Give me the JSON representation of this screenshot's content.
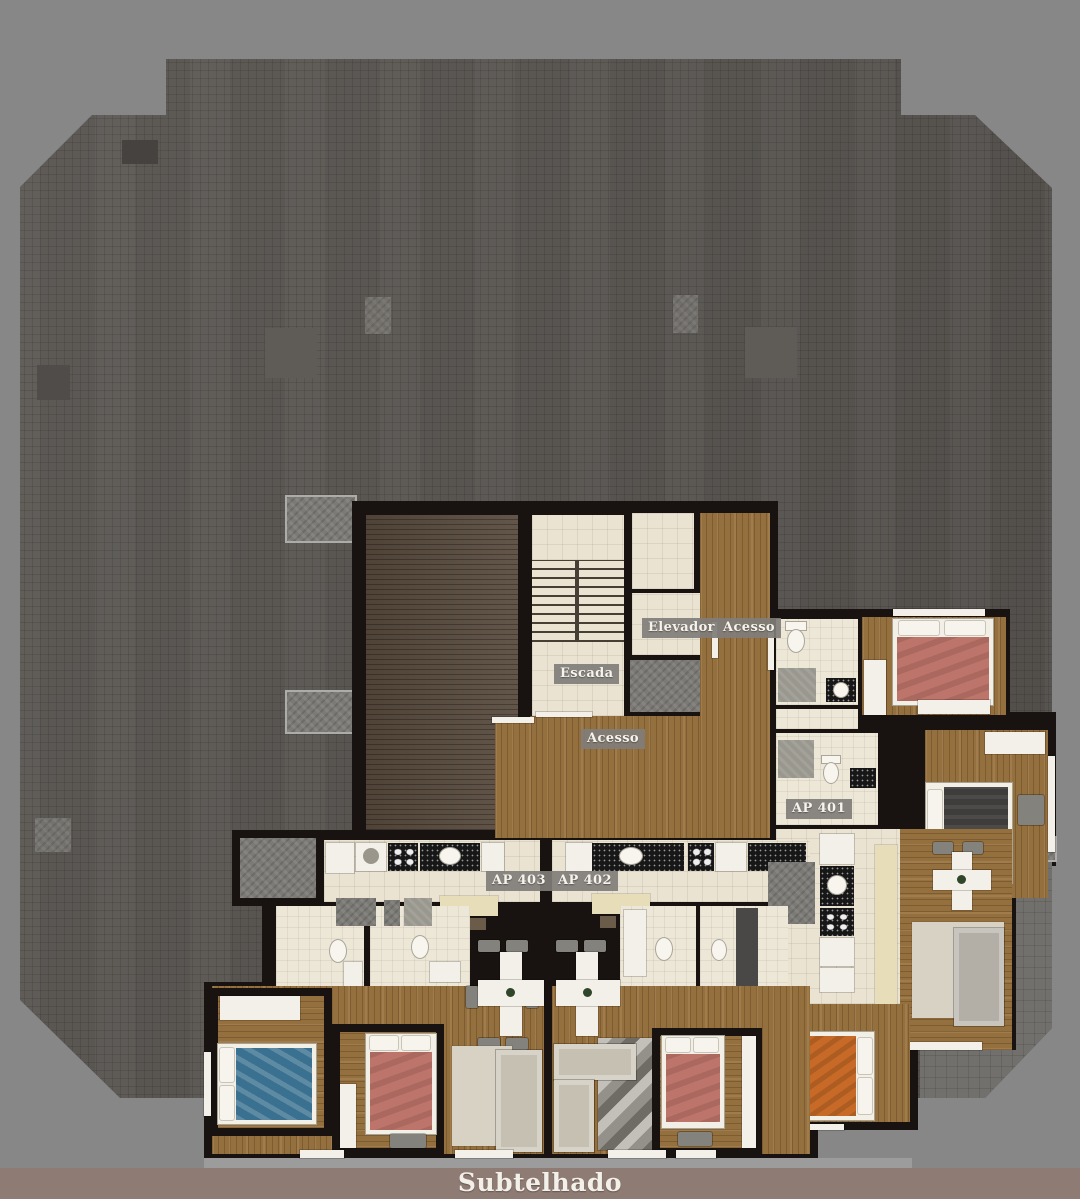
{
  "scene": {
    "type": "apartment-floor-plan-render",
    "floor_name": "Subtelhado"
  },
  "footer": {
    "title": "Subtelhado"
  },
  "plan_labels": {
    "elevator": "Elevador",
    "stairs": "Escada",
    "access_upper": "Acesso",
    "access_lower": "Acesso",
    "apartment_401": "AP 401",
    "apartment_402": "AP 402",
    "apartment_403": "AP 403"
  },
  "colors": {
    "background": "#878787",
    "roof": "#56524e",
    "wall": "#181310",
    "wood": "#95703f",
    "wood_dark": "#5a4c3f",
    "tile_cream": "#eae3d2",
    "stone": "#7c7a75",
    "terrace": "#71706d",
    "slab": "#9c9c9c",
    "label_chip": "#807d78",
    "label_text": "#f6f3ed",
    "footer_bar": "#8e7b73",
    "footer_text": "#f3efe9",
    "bed_salmon": "#bd746a",
    "bed_blue": "#3b7190",
    "bed_orange": "#c76a27",
    "bed_dark": "#3e3d3b",
    "sofa": "#c6c0b2"
  }
}
